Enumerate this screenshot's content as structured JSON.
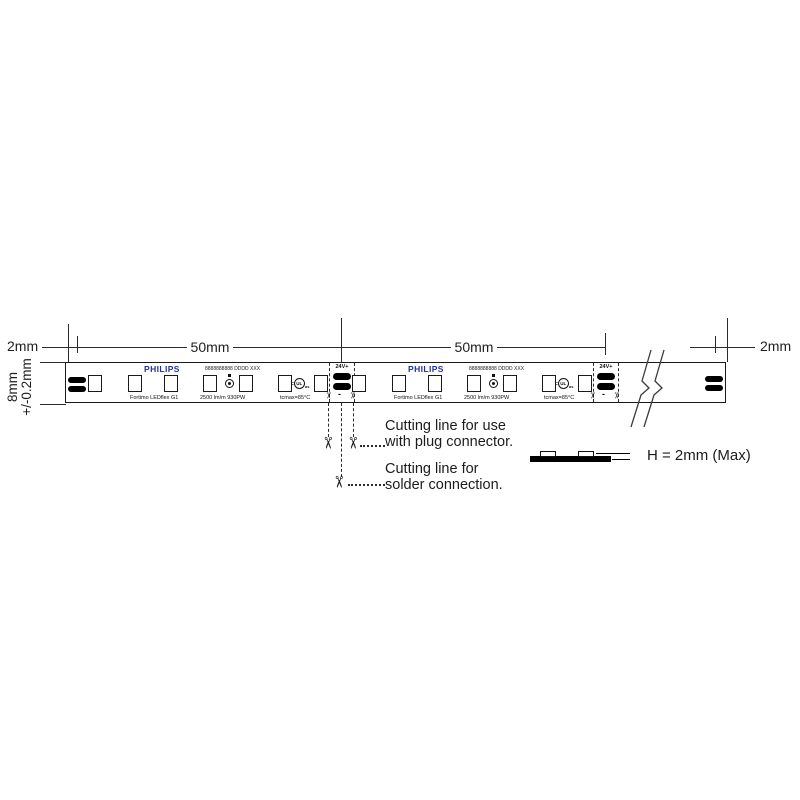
{
  "dimensions": {
    "left_end": "2mm",
    "right_end": "2mm",
    "pitch_1": "50mm",
    "pitch_2": "50mm",
    "height_value": "8mm",
    "height_tolerance": "+/-0.2mm"
  },
  "strip": {
    "brand": "PHILIPS",
    "brand_color": "#22339b",
    "serial": "8888888888 DDDD XXX",
    "product": "Fortimo LEDflex G1",
    "flux_spec": "2500 lm/m 930PW",
    "tc_spec": "tcmax=85°C",
    "cut_voltage": "24V+",
    "cut_minus": "-",
    "ul_prefix": "c",
    "ul_mark": "UL",
    "ul_suffix": "us"
  },
  "annotations": {
    "plug_cut_1": "Cutting line for use",
    "plug_cut_2": "with plug connector.",
    "solder_cut_1": "Cutting line for",
    "solder_cut_2": "solder connection.",
    "profile_height": "H = 2mm (Max)"
  },
  "icons": {
    "scissors": "✂"
  }
}
